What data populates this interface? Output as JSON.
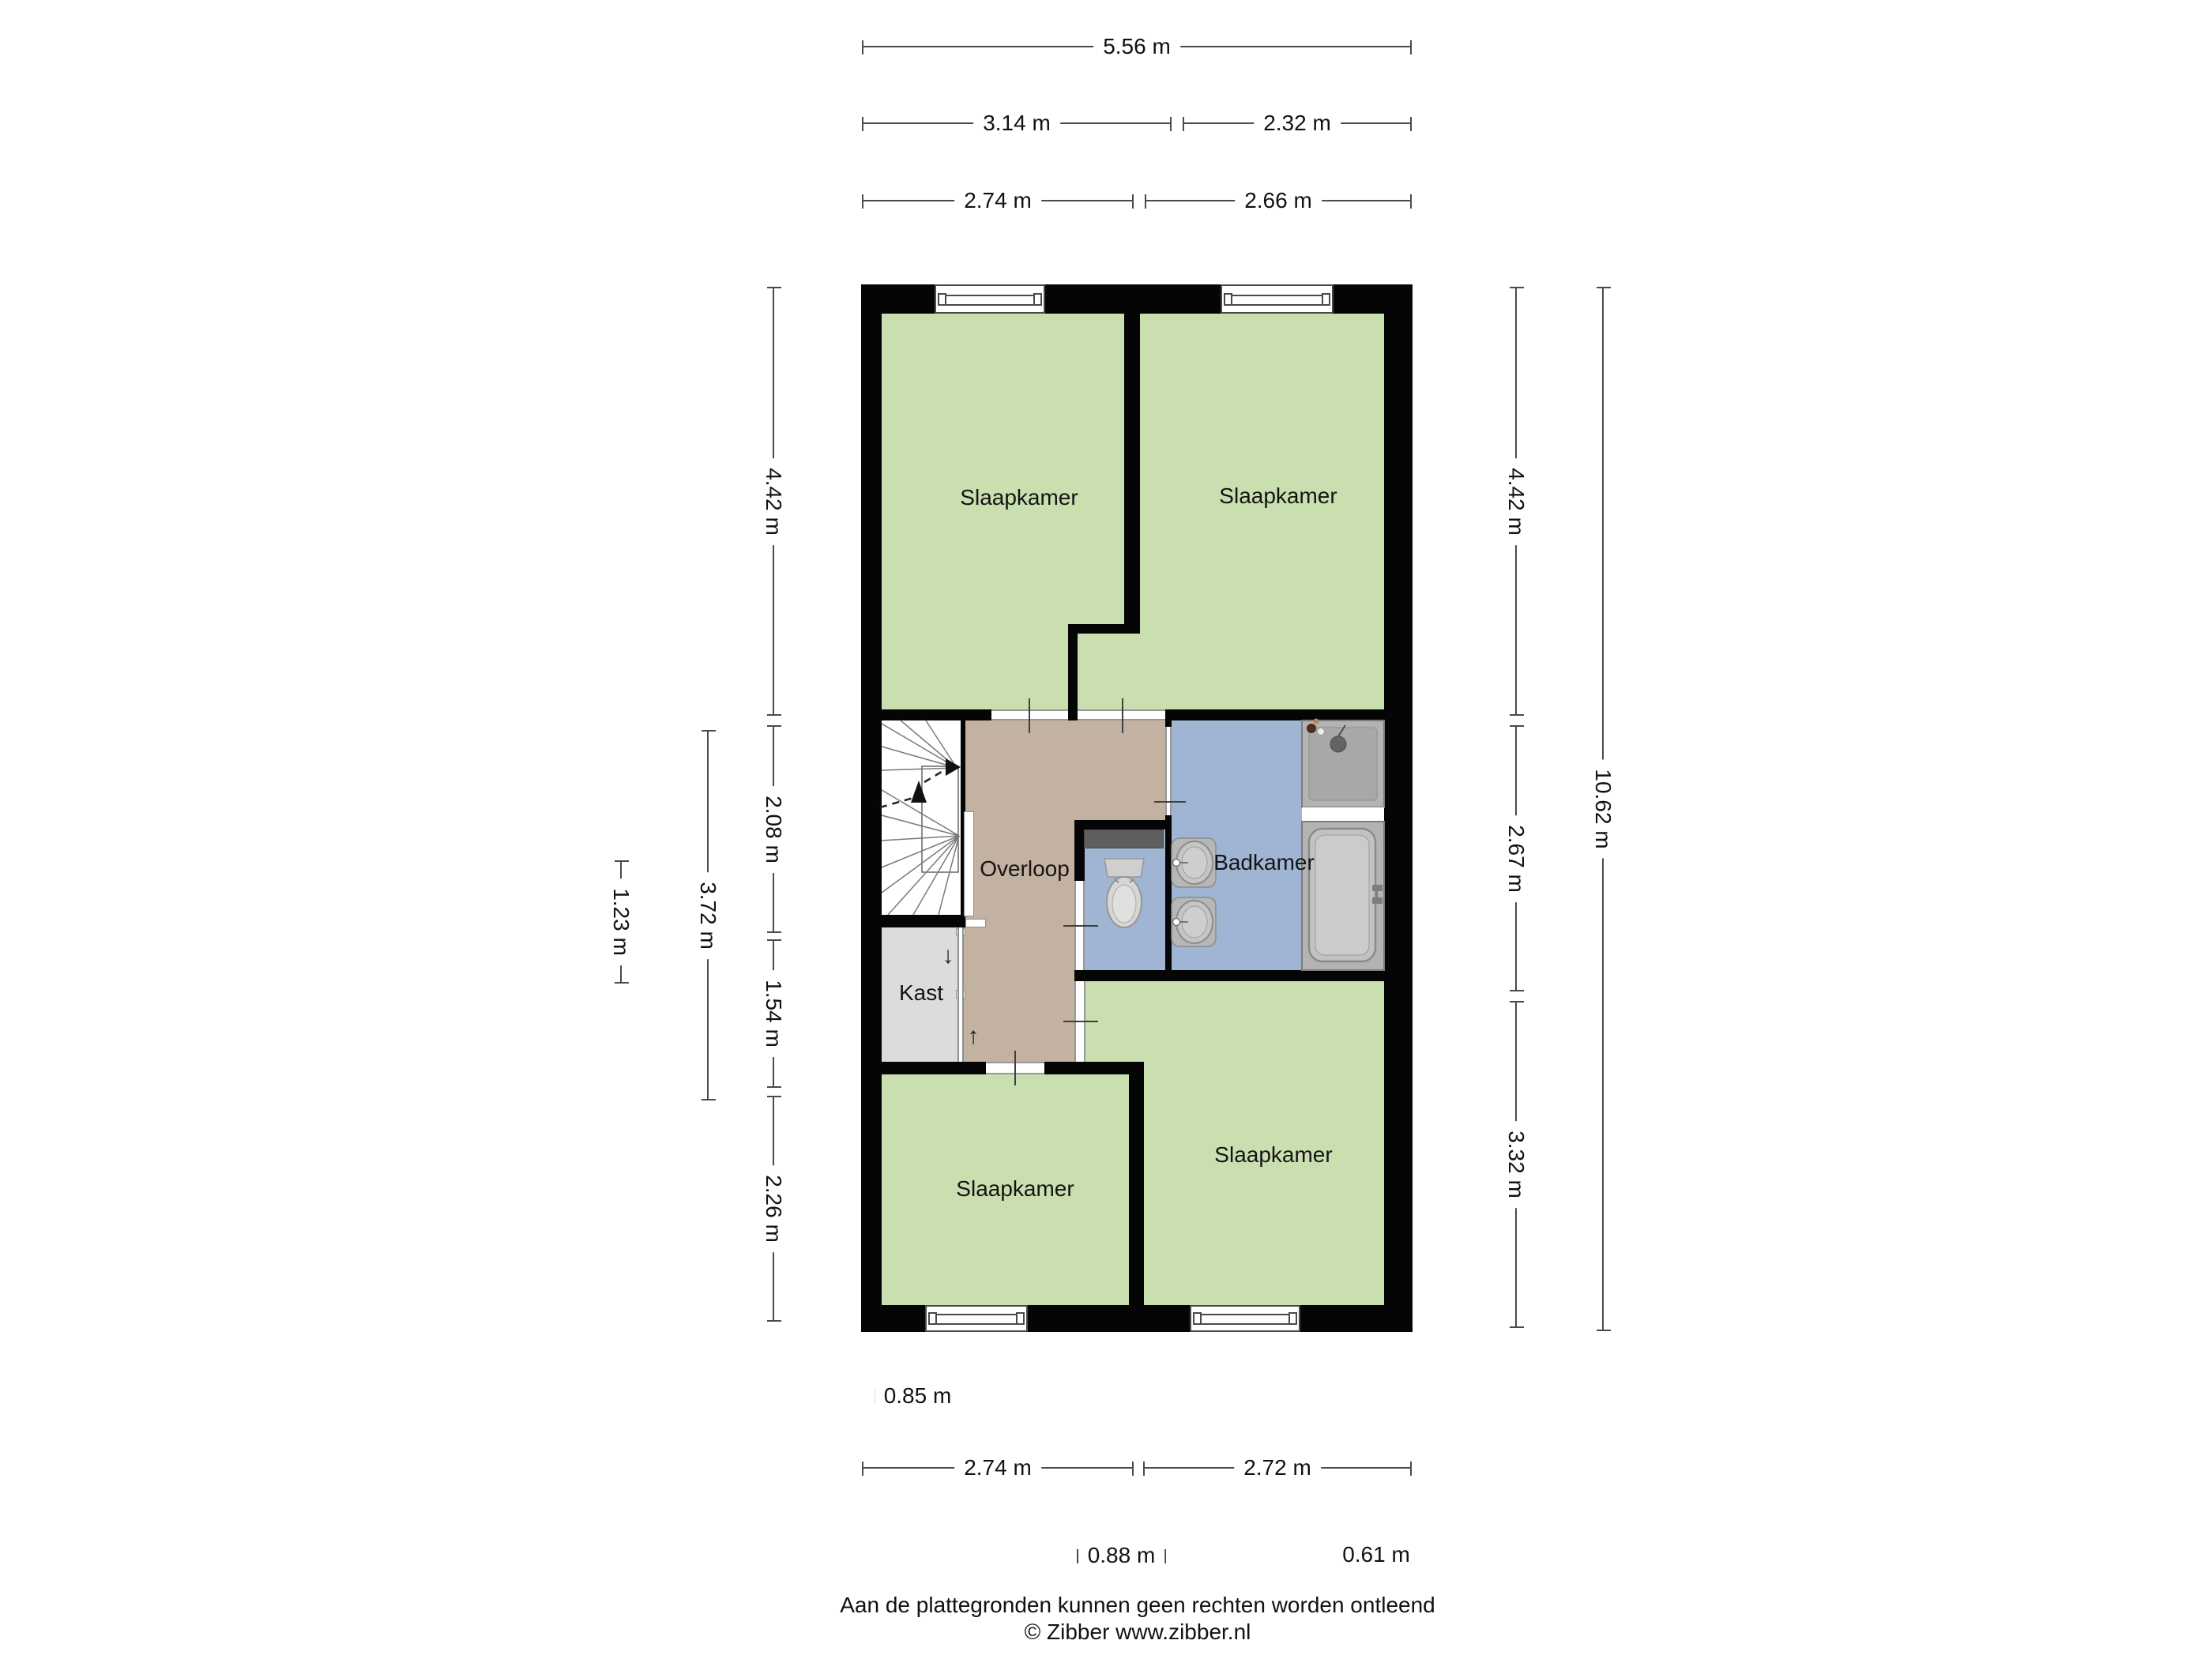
{
  "rooms": {
    "bedroom_top_left": "Slaapkamer",
    "bedroom_top_right": "Slaapkamer",
    "landing": "Overloop",
    "bathroom": "Badkamer",
    "closet": "Kast",
    "bedroom_bottom_left": "Slaapkamer",
    "bedroom_bottom_right": "Slaapkamer"
  },
  "annotations": {
    "stairs_down_arrow": "↓",
    "stairs_up_arrow": "↑"
  },
  "dimensions": {
    "top": [
      "5.56 m",
      "3.14 m",
      "2.32 m",
      "2.74 m",
      "2.66 m"
    ],
    "bottom": [
      "0.85 m",
      "2.74 m",
      "2.72 m",
      "0.88 m",
      "0.61 m"
    ],
    "left": [
      "4.42 m",
      "2.08 m",
      "1.54 m",
      "2.26 m",
      "3.72 m",
      "1.23 m"
    ],
    "right": [
      "4.42 m",
      "2.67 m",
      "3.32 m",
      "10.62 m"
    ]
  },
  "footer": {
    "line1": "Aan de plattegronden kunnen geen rechten worden ontleend",
    "line2": "© Zibber www.zibber.nl"
  },
  "colors": {
    "wall": "#050505",
    "bedroom_fill": "#c9dfaf",
    "landing_fill": "#c3b1a2",
    "bathroom_fill": "#9fb5d3",
    "closet_fill": "#dcdcdc",
    "fixture_gray": "#b3b3b3",
    "dimension_line": "#4a4a4a"
  }
}
